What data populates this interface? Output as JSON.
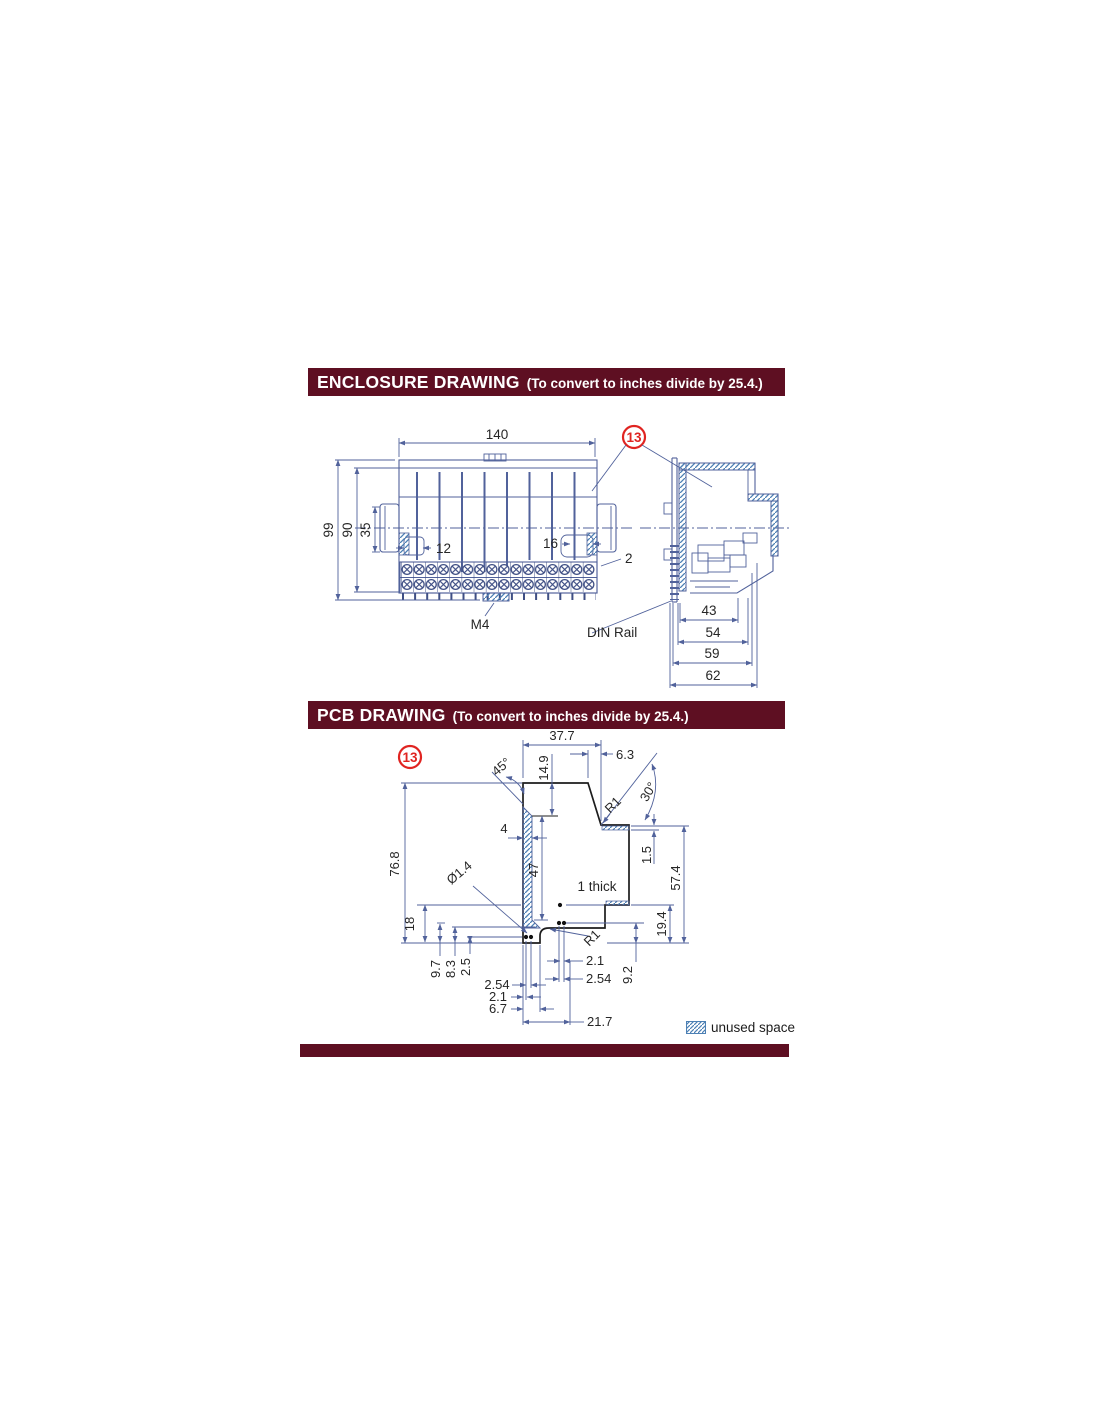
{
  "colors": {
    "maroon": "#5e0f22",
    "line_blue": "#51629b",
    "hatch_blue": "#4c80b4",
    "callout_red": "#e02421",
    "ink": "#262626"
  },
  "enclosure_section": {
    "header": {
      "title": "ENCLOSURE DRAWING",
      "subtitle": "(To convert to inches divide by 25.4.)"
    },
    "callout": "13",
    "front": {
      "dim_width": "140",
      "dim_height": "99",
      "dim_body": "90",
      "dim_ear": "35",
      "dim_left_slot": "12",
      "dim_right_slot": "16",
      "dim_lip": "2",
      "screw_label": "M4",
      "din_rail_label": "DIN Rail"
    },
    "side": {
      "dim_43": "43",
      "dim_54": "54",
      "dim_59": "59",
      "dim_62": "62"
    }
  },
  "pcb_section": {
    "header": {
      "title": "PCB DRAWING",
      "subtitle": "(To convert to inches divide by 25.4.)"
    },
    "callout": "13",
    "dims": {
      "w_top": "37.7",
      "h_149": "14.9",
      "w_63": "6.3",
      "ang45": "45°",
      "ang30": "30°",
      "r1_top": "R1",
      "r1_bot": "R1",
      "w4": "4",
      "h47": "47",
      "h768": "76.8",
      "h15": "1.5",
      "h574": "57.4",
      "hole": "Ø1.4",
      "thick": "1 thick",
      "h18": "18",
      "h194": "19.4",
      "h97": "9.7",
      "h83": "8.3",
      "h25": "2.5",
      "p254l": "2.54",
      "p21l": "2.1",
      "p67": "6.7",
      "w217": "21.7",
      "p21r": "2.1",
      "p254r": "2.54",
      "h92": "9.2"
    }
  },
  "legend": {
    "unused_space": "unused space"
  }
}
